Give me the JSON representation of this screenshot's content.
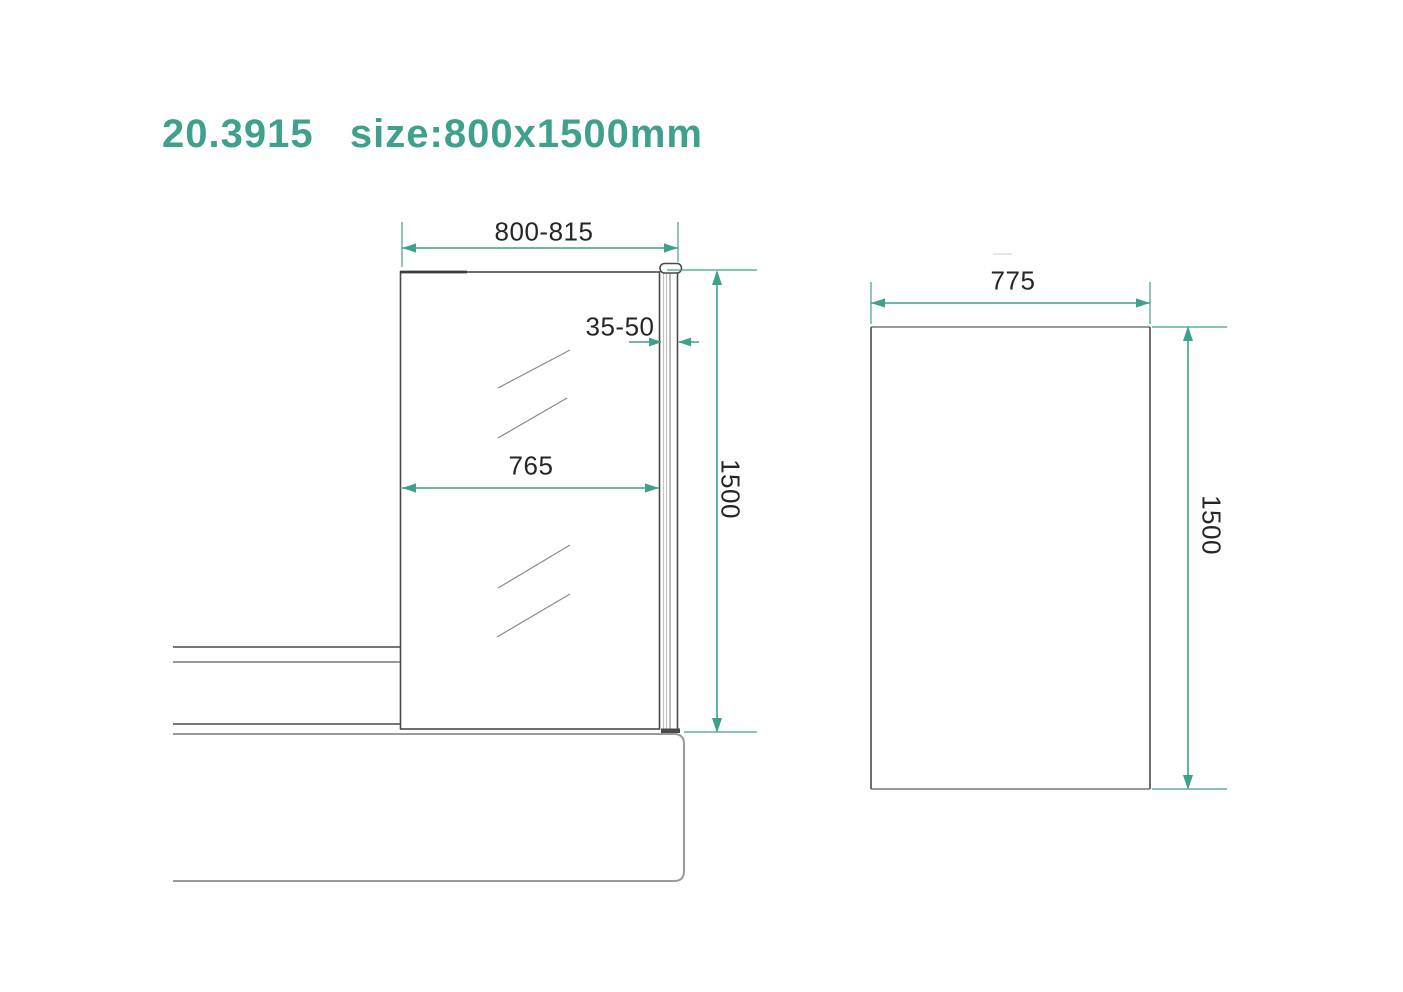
{
  "title": "20.3915   size:800x1500mm",
  "accent_color": "#3FA08E",
  "drawing": {
    "front_view": {
      "overall_width": "800-815",
      "wall_profile_adjust": "35-50",
      "glass_width": "765",
      "height": "1500"
    },
    "side_view": {
      "glass_width": "775",
      "height": "1500"
    }
  }
}
